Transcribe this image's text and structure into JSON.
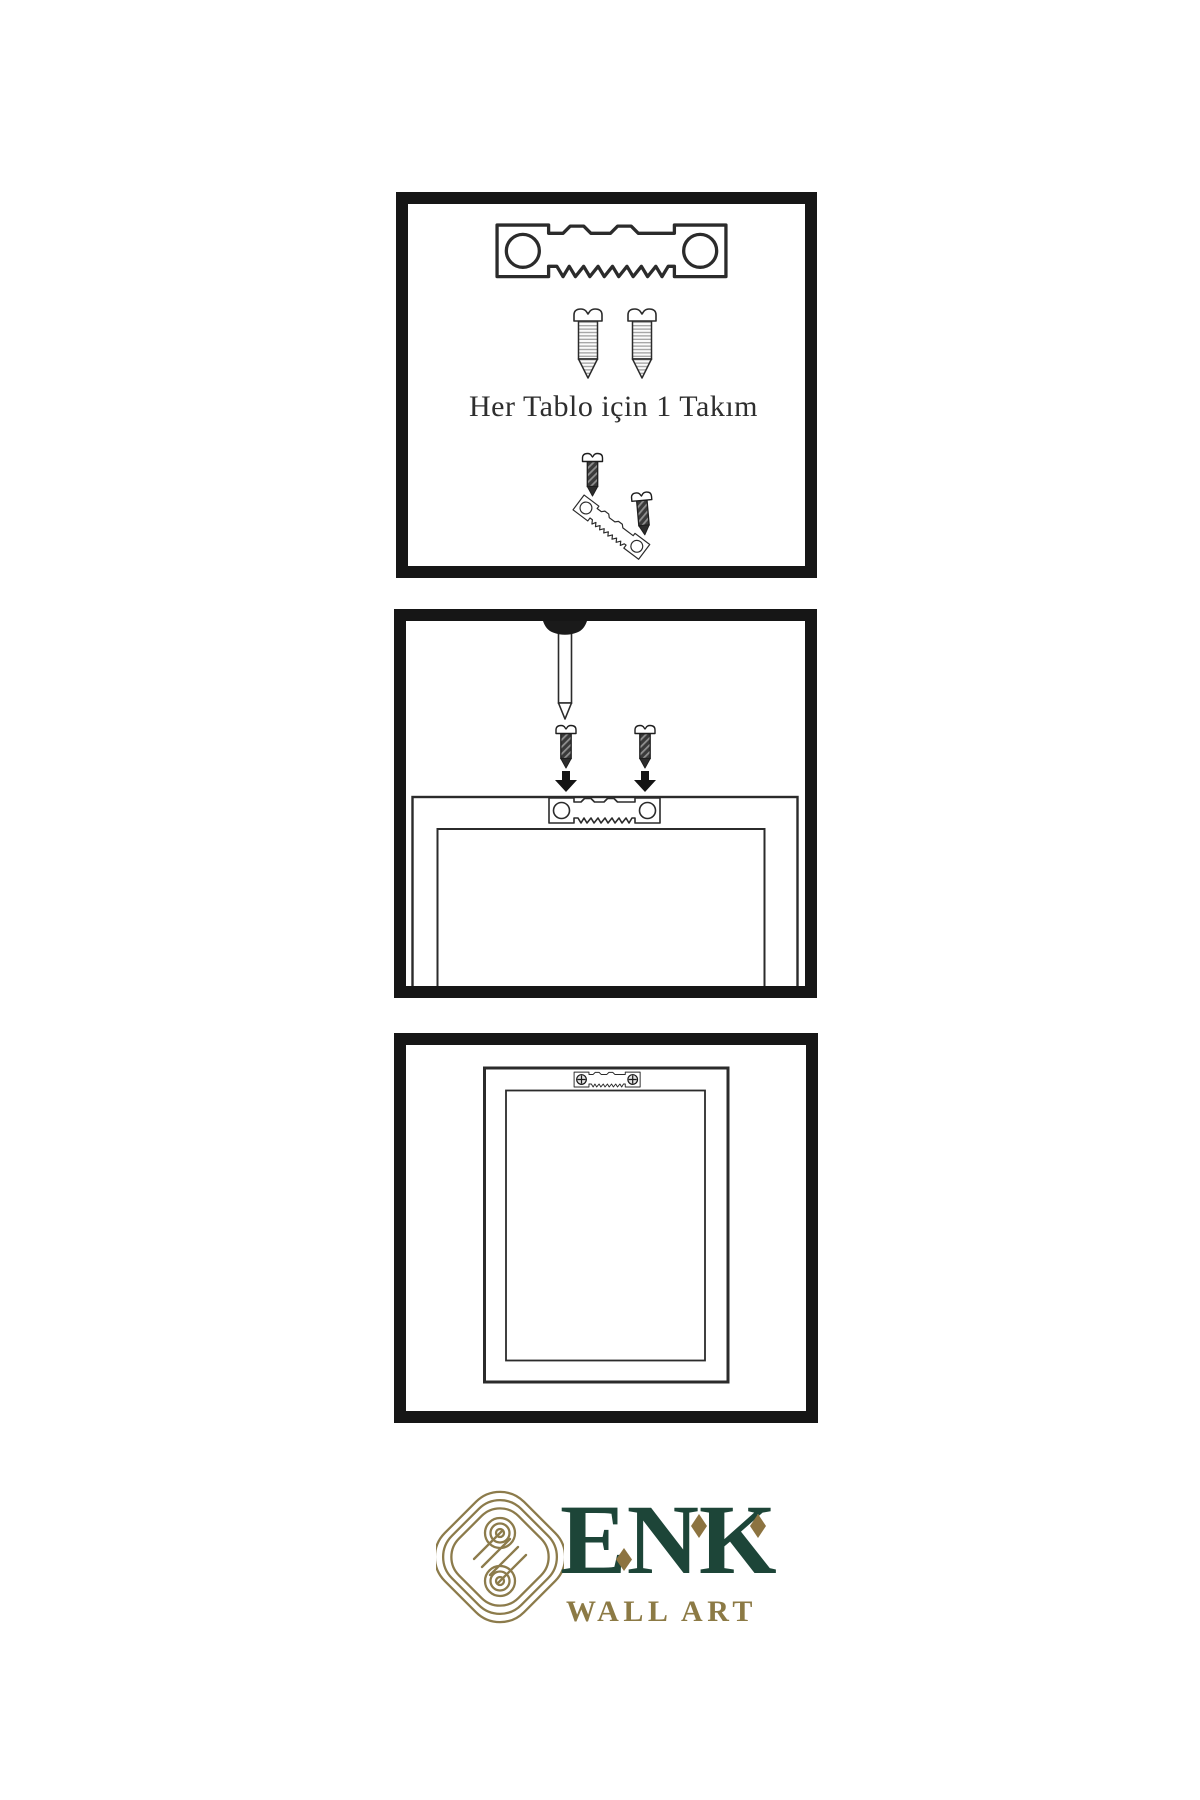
{
  "page": {
    "background": "#ffffff"
  },
  "caption": {
    "text": "Her Tablo için 1 Takım"
  },
  "brand": {
    "name": "ENK",
    "tagline": "WALL ART",
    "colors": {
      "green": "#1d4538",
      "gold": "#8c7b4b",
      "diamond_gold": "#8c7340"
    }
  },
  "colors": {
    "panel_border": "#161616",
    "line_art": "#2b2b2b",
    "screw_dark_fill": "#3a3a3a",
    "arrow_fill": "#141414"
  },
  "icons": {
    "step1": [
      "sawtooth-hanger-icon",
      "screw-icon",
      "screw-icon",
      "screw-into-hanger-icon"
    ],
    "step2": [
      "wall-nail-icon",
      "screw-icon",
      "screw-icon",
      "down-arrow-icon",
      "down-arrow-icon",
      "frame-back-icon",
      "sawtooth-hanger-icon"
    ],
    "step3": [
      "hanging-frame-icon",
      "mounted-hanger-icon"
    ],
    "brand": [
      "interlocking-knot-icon",
      "diamond-accent-icon"
    ]
  }
}
